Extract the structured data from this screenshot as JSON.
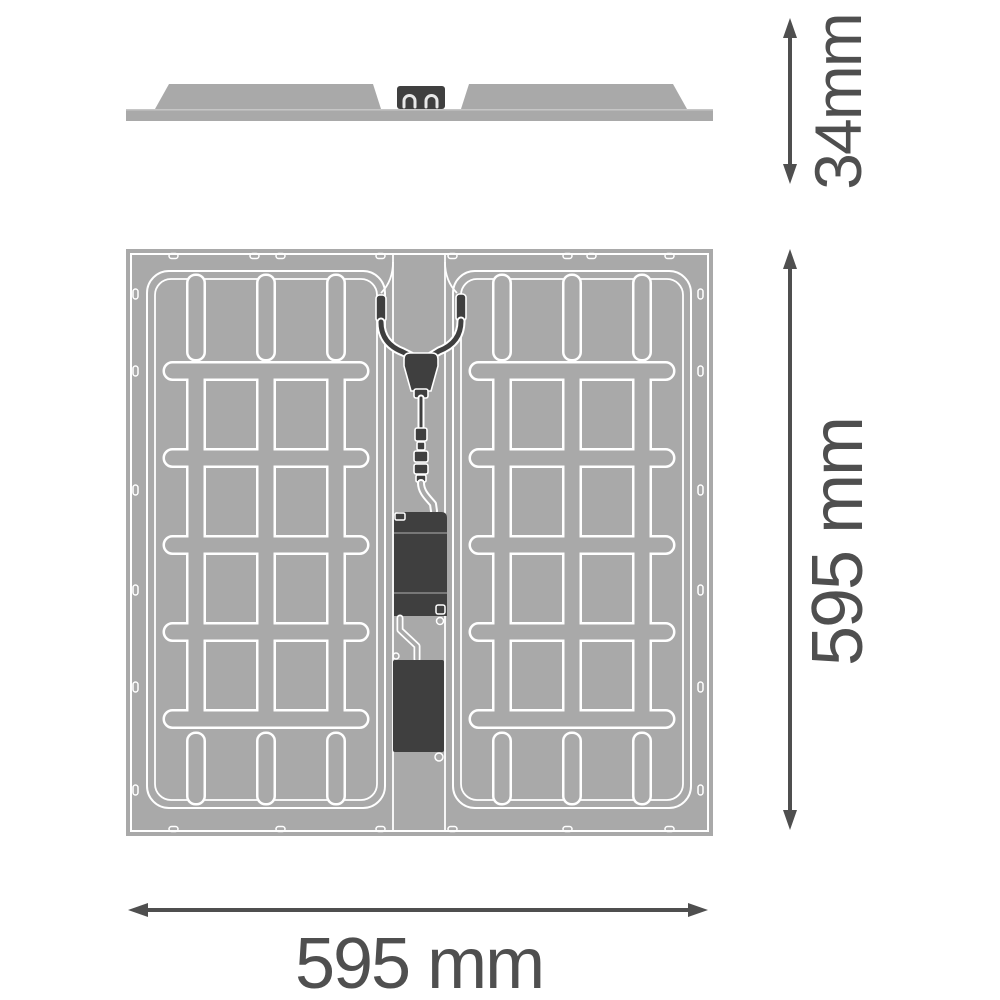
{
  "drawing": {
    "type": "technical-dimension-drawing",
    "product": "square LED panel luminaire, rear and side views"
  },
  "dimensions": {
    "profile_height_label": "34mm",
    "panel_height_label": "595 mm",
    "panel_width_label": "595 mm"
  },
  "colors": {
    "background": "#ffffff",
    "panel_gray": "#a9a9a9",
    "outline_white": "#ffffff",
    "component_dark": "#3f3f3f",
    "dimension_gray": "#4f4f4f"
  }
}
